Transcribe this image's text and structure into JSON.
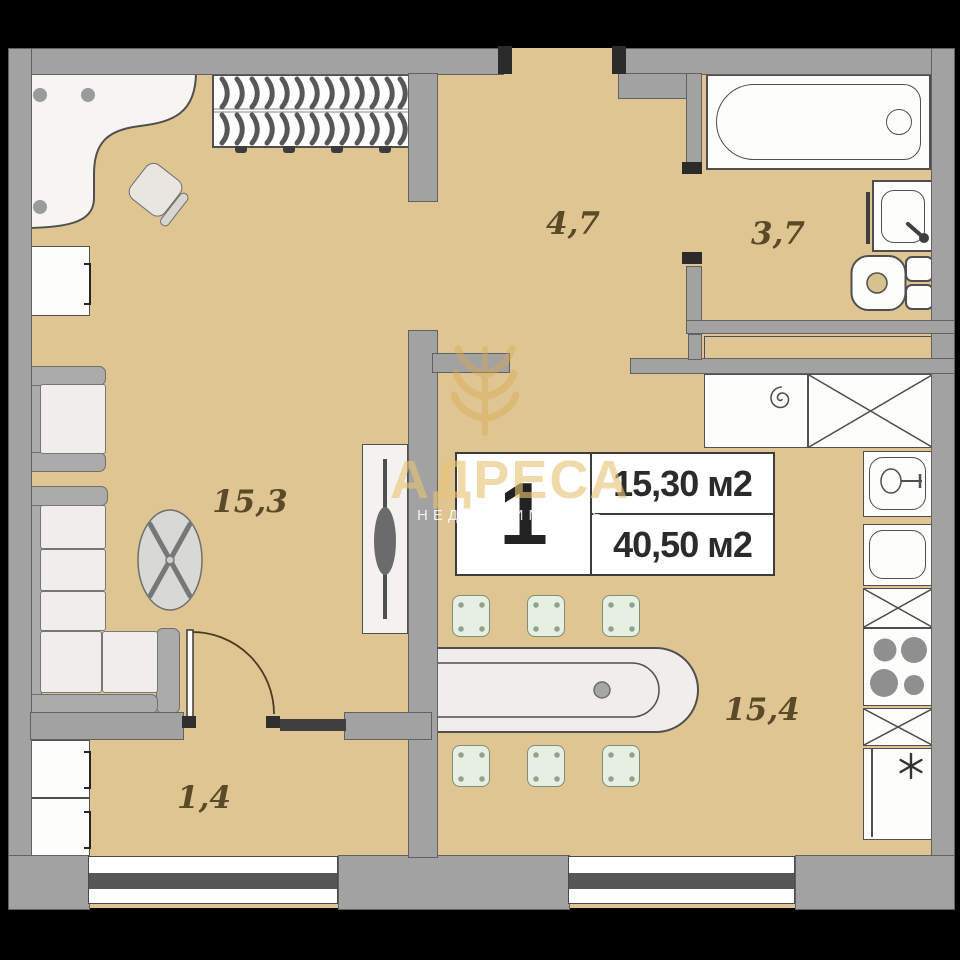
{
  "brand": {
    "name": "АДРЕСА",
    "tagline": "НЕДВИЖИМОСТЬ"
  },
  "unit": {
    "number": "1",
    "room_area": "15,30 м2",
    "total_area": "40,50 м2"
  },
  "rooms": {
    "hall_entry": {
      "label": "4,7"
    },
    "bathroom": {
      "label": "3,7"
    },
    "living_room": {
      "label": "15,3"
    },
    "kitchen_living": {
      "label": "15,4"
    },
    "hall_small": {
      "label": "1,4"
    }
  },
  "colors": {
    "floor": "#dfc592",
    "wall": "#a2a2a2",
    "watermark_gold": "#e8c476",
    "label_text": "#5a4a28",
    "fixture_outline": "#4f4f4f"
  }
}
